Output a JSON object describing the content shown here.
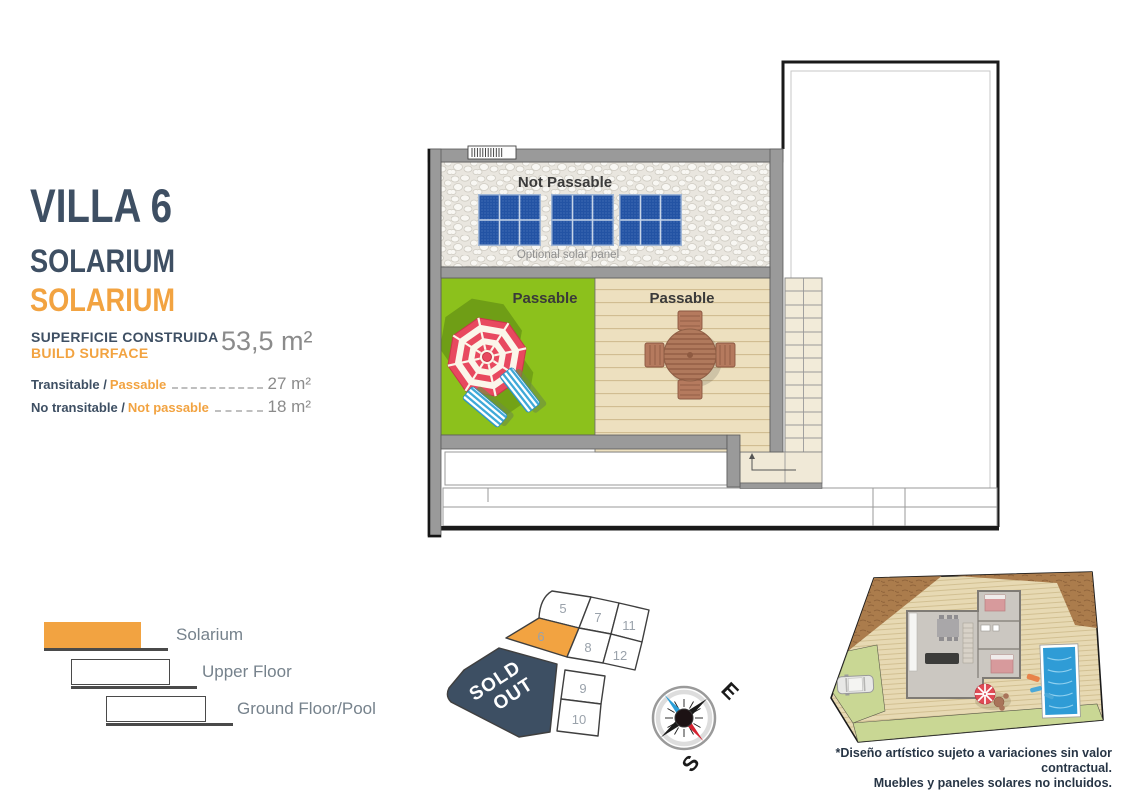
{
  "header": {
    "villa_title": "VILLA 6",
    "subtitle_primary": "SOLARIUM",
    "subtitle_secondary": "SOLARIUM"
  },
  "surface": {
    "label_primary": "SUPERFICIE CONSTRUIDA",
    "label_secondary": "BUILD SURFACE",
    "total_value": "53,5 m²"
  },
  "areas": [
    {
      "label_primary": "Transitable /",
      "label_secondary": "Passable",
      "value": "27 m²"
    },
    {
      "label_primary": "No transitable /",
      "label_secondary": "Not passable",
      "value": "18 m²"
    }
  ],
  "floor_plan": {
    "not_passable_label": "Not Passable",
    "solar_panel_note": "Optional solar panel",
    "passable_label_grass": "Passable",
    "passable_label_deck": "Passable",
    "solar_panel_count": 3
  },
  "legend": {
    "items": [
      {
        "label": "Solarium",
        "color": "#F2A341"
      },
      {
        "label": "Upper Floor",
        "color": "#FFFFFF"
      },
      {
        "label": "Ground Floor/Pool",
        "color": "#FFFFFF"
      }
    ]
  },
  "plot_map": {
    "plots": [
      {
        "label": "5"
      },
      {
        "label": "7"
      },
      {
        "label": "11"
      },
      {
        "label": "6",
        "highlighted": true
      },
      {
        "label": "8"
      },
      {
        "label": "12"
      },
      {
        "label": "9"
      },
      {
        "label": "10"
      }
    ],
    "sold_out_line1": "SOLD",
    "sold_out_line2": "OUT",
    "highlight_color": "#F2A341",
    "sold_out_color": "#3D4F63"
  },
  "compass": {
    "east_label": "E",
    "south_label": "S"
  },
  "disclaimer": {
    "line1": "*Diseño artístico sujeto a variaciones sin valor contractual.",
    "line2": "Muebles y paneles solares no incluidos."
  },
  "colors": {
    "accent_orange": "#F2A341",
    "dark_slate": "#3E4F63",
    "muted_gray": "#8B8B8B",
    "wall_gray": "#9A9A9A",
    "grass_green": "#8CC11C",
    "deck_beige": "#EDE0BF",
    "panel_blue": "#2353A4",
    "pool_blue": "#2F9CD6",
    "legend_text_gray": "#76828C"
  }
}
